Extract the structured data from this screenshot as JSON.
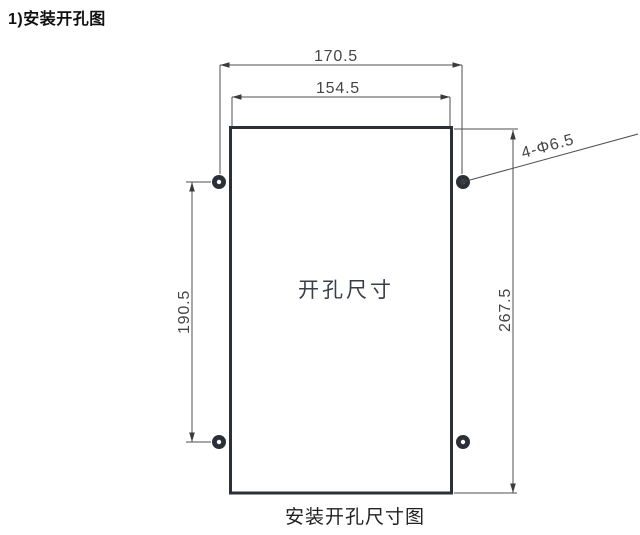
{
  "page": {
    "title": "1)安装开孔图",
    "caption": "安装开孔尺寸图"
  },
  "drawing": {
    "center_label": "开孔尺寸",
    "dimensions": {
      "hole_span_width": "170.5",
      "cutout_width": "154.5",
      "hole_span_height": "190.5",
      "cutout_height": "267.5",
      "hole_callout": "4-Φ6.5"
    },
    "colors": {
      "outline": "#2b2f38",
      "dimension_line": "#4f4f4f",
      "dimension_text": "#454545"
    }
  }
}
